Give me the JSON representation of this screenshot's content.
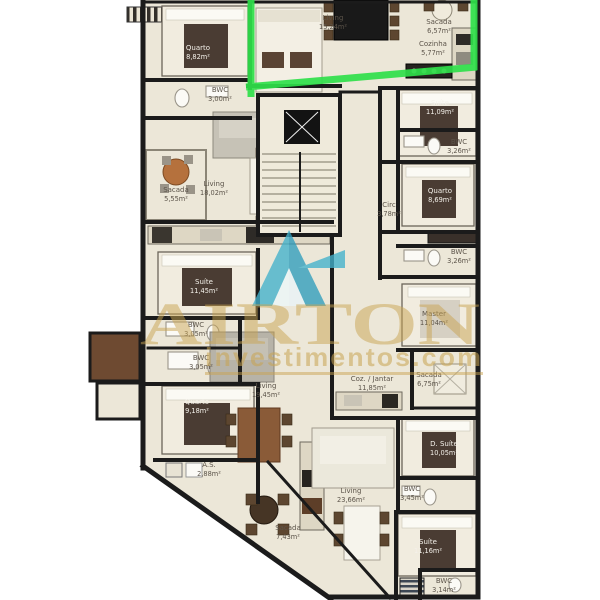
{
  "watermark": {
    "brand": "AIRTON",
    "tagline": "investimentos.com",
    "logo": "airton-logo"
  },
  "colors": {
    "highlight_green": "#2fdf4a",
    "watermark_gold": "#c9a452",
    "logo_teal": "#43b2cc",
    "logo_teal_dark": "#2f9dbd",
    "plan_fill": "#ece7d8",
    "wall": "#1b1b1b"
  },
  "rooms": [
    {
      "name": "Quarto",
      "area": "8,82m²"
    },
    {
      "name": "BWC",
      "area": "3,00m²"
    },
    {
      "name": "Sacada",
      "area": "5,55m²"
    },
    {
      "name": "Living",
      "area": "18,02m²"
    },
    {
      "name": "Living",
      "area": "15,24m²"
    },
    {
      "name": "Sacada",
      "area": "6,57m²"
    },
    {
      "name": "Cozinha",
      "area": "5,77m²"
    },
    {
      "name": "Suíte",
      "area": "11,09m²"
    },
    {
      "name": "BWC",
      "area": "3,26m²"
    },
    {
      "name": "Quarto",
      "area": "8,69m²"
    },
    {
      "name": "Circ",
      "area": "3,78m²"
    },
    {
      "name": "BWC",
      "area": "3,26m²"
    },
    {
      "name": "Master",
      "area": "11,04m²"
    },
    {
      "name": "Coz. / Jantar",
      "area": "11,85m²"
    },
    {
      "name": "Sacada",
      "area": "6,75m²"
    },
    {
      "name": "Suíte",
      "area": "11,45m²"
    },
    {
      "name": "BWC",
      "area": "3,05m²"
    },
    {
      "name": "BWC",
      "area": "3,05m²"
    },
    {
      "name": "Quarto",
      "area": "9,18m²"
    },
    {
      "name": "Living",
      "area": "19,45m²"
    },
    {
      "name": "A.S.",
      "area": "2,88m²"
    },
    {
      "name": "Sacada",
      "area": "7,43m²"
    },
    {
      "name": "Living",
      "area": "23,66m²"
    },
    {
      "name": "D. Suíte",
      "area": "10,05m²"
    },
    {
      "name": "BWC",
      "area": "3,45m²"
    },
    {
      "name": "Suíte",
      "area": "11,16m²"
    },
    {
      "name": "BWC",
      "area": "3,14m²"
    }
  ]
}
